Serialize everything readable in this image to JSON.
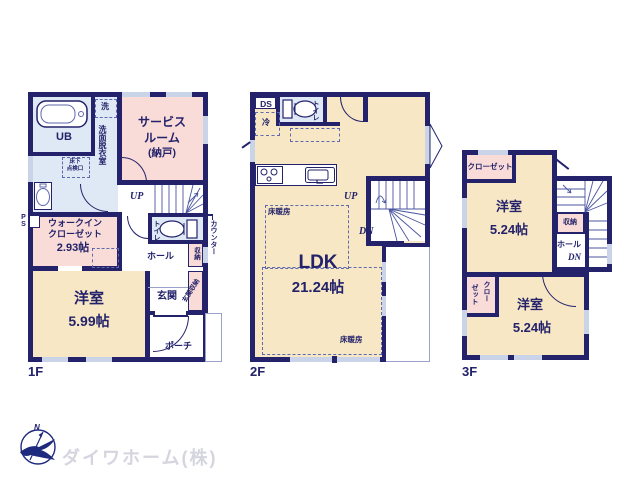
{
  "colors": {
    "wall_navy": "#23226b",
    "room_cream": "#f7e7c4",
    "room_pink": "#f9dcd7",
    "room_blue": "#dfe9f5",
    "window_light": "#c9d4e8",
    "logo_text_gray": "#d5d5df"
  },
  "logo": {
    "company_name": "ダイワホーム(株)",
    "compass_n": "N"
  },
  "floor1": {
    "floor_label": "1F",
    "unit_bath": "UB",
    "washer": "洗",
    "washroom": "洗面脱衣室",
    "hatch_line1": "床下",
    "hatch_line2": "点検口",
    "service_room_l1": "サービス",
    "service_room_l2": "ルーム",
    "service_room_l3": "(納戸)",
    "stairs_up": "UP",
    "toilet": "トイレ",
    "counter": "カウンター",
    "storage": "収納",
    "hall": "ホール",
    "wic_l1": "ウォークイン",
    "wic_l2": "クローゼット",
    "wic_size": "2.93帖",
    "pipe_space": "PS",
    "entrance": "玄関",
    "entrance_storage": "玄関収納",
    "western_room": "洋室",
    "western_room_size": "5.99帖",
    "porch": "ポーチ"
  },
  "floor2": {
    "floor_label": "2F",
    "duct_space": "DS",
    "fridge": "冷",
    "toilet": "トイレ",
    "stairs_up": "UP",
    "stairs_down": "DN",
    "floor_heating_1": "床暖房",
    "floor_heating_2": "床暖房",
    "ldk": "LDK",
    "ldk_size": "21.24帖"
  },
  "floor3": {
    "floor_label": "3F",
    "closet_top": "クローゼット",
    "western_room_1": "洋室",
    "western_room_1_size": "5.24帖",
    "storage": "収納",
    "hall": "ホール",
    "stairs_down": "DN",
    "closet_v1": "クロー",
    "closet_v2": "ゼット",
    "western_room_2": "洋室",
    "western_room_2_size": "5.24帖"
  }
}
